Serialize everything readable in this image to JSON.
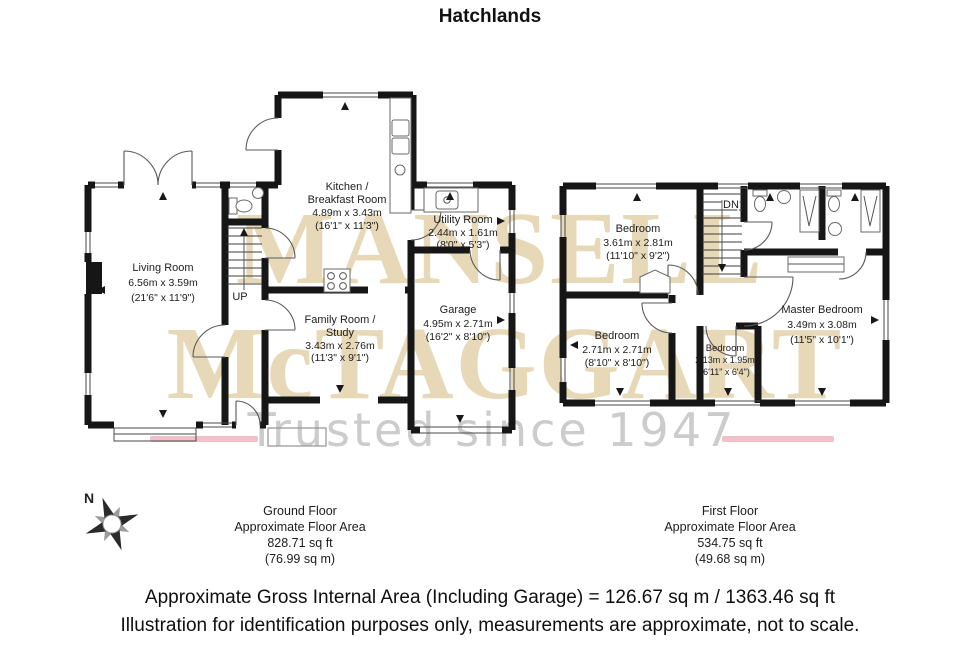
{
  "title": "Hatchlands",
  "colors": {
    "wall": "#161616",
    "watermark_beige": "#e7d9b8",
    "watermark_gray": "#cccccc",
    "accent_pink": "#f2c0c9",
    "background": "#ffffff"
  },
  "watermark": {
    "line1": "MANSELL",
    "line2": "McTAGGART",
    "tagline": "Trusted since 1947"
  },
  "compass": {
    "label": "N"
  },
  "ground_floor": {
    "stair_label": "UP",
    "rooms": [
      {
        "lines": [
          "Living Room"
        ],
        "metric": "6.56m x 3.59m",
        "imperial": "(21'6\" x 11'9\")"
      },
      {
        "lines": [
          "Kitchen /",
          "Breakfast Room"
        ],
        "metric": "4.89m x 3.43m",
        "imperial": "(16'1\" x 11'3\")"
      },
      {
        "lines": [
          "Utility Room"
        ],
        "metric": "2.44m x 1.61m",
        "imperial": "(8'0\" x 5'3\")"
      },
      {
        "lines": [
          "Family Room /",
          "Study"
        ],
        "metric": "3.43m x 2.76m",
        "imperial": "(11'3\" x 9'1\")"
      },
      {
        "lines": [
          "Garage"
        ],
        "metric": "4.95m x 2.71m",
        "imperial": "(16'2\" x 8'10\")"
      }
    ],
    "caption": {
      "line1": "Ground Floor",
      "line2": "Approximate Floor Area",
      "line3": "828.71 sq ft",
      "line4": "(76.99 sq m)"
    }
  },
  "first_floor": {
    "stair_label": "DN",
    "rooms": [
      {
        "lines": [
          "Bedroom"
        ],
        "metric": "3.61m x 2.81m",
        "imperial": "(11'10\" x 9'2\")"
      },
      {
        "lines": [
          "Bedroom"
        ],
        "metric": "2.71m x 2.71m",
        "imperial": "(8'10\" x 8'10\")"
      },
      {
        "lines": [
          "Bedroom"
        ],
        "metric": "2.13m x 1.95m",
        "imperial": "(6'11\" x 6'4\")"
      },
      {
        "lines": [
          "Master Bedroom"
        ],
        "metric": "3.49m x 3.08m",
        "imperial": "(11'5\" x 10'1\")"
      }
    ],
    "caption": {
      "line1": "First Floor",
      "line2": "Approximate Floor Area",
      "line3": "534.75 sq ft",
      "line4": "(49.68 sq m)"
    }
  },
  "footer": {
    "line1": "Approximate Gross Internal Area (Including Garage) = 126.67 sq m / 1363.46 sq ft",
    "line2": "Illustration for identification purposes only, measurements are approximate, not to scale."
  }
}
